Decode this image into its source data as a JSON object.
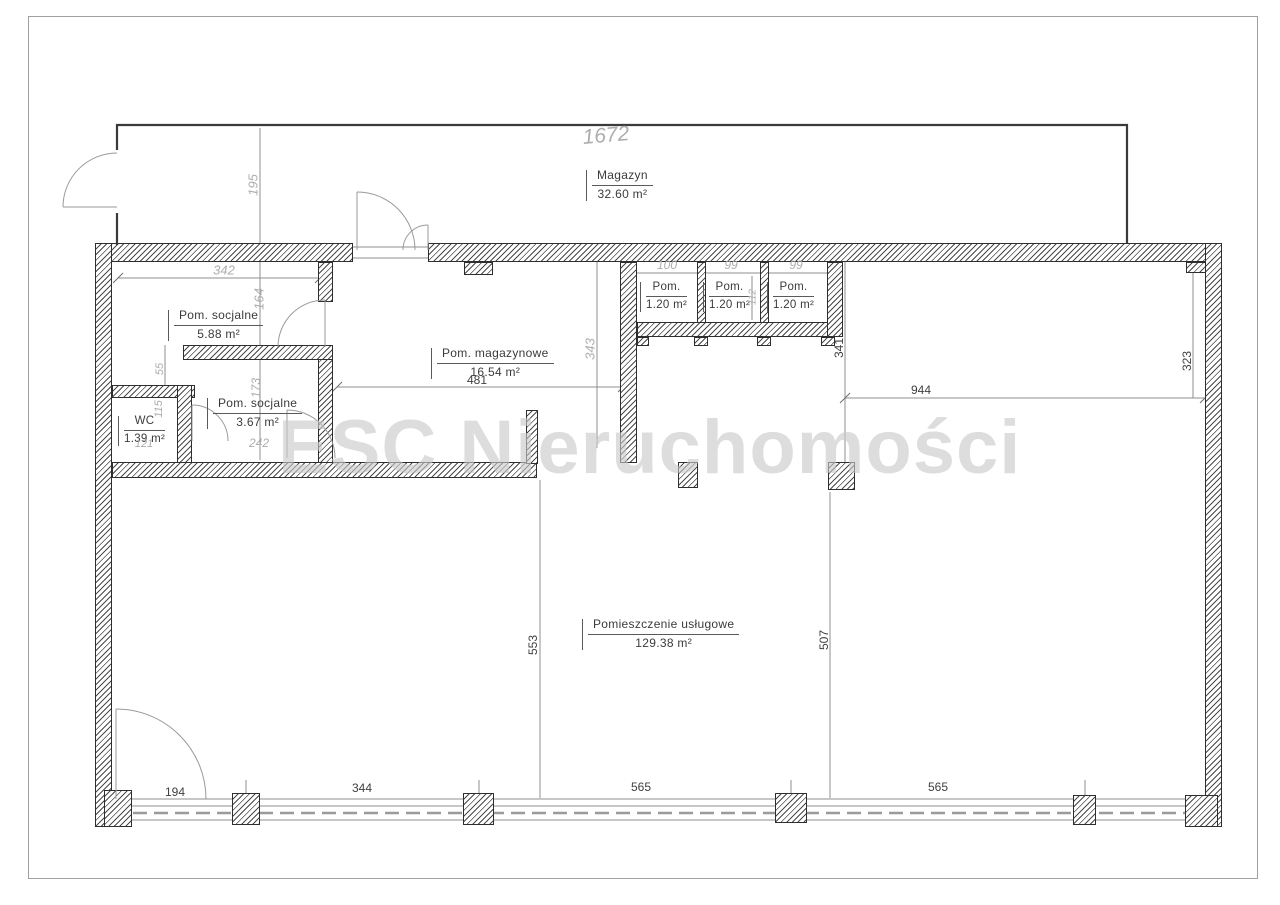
{
  "watermark": "ESC Nieruchomości",
  "rooms": {
    "magazyn": {
      "name": "Magazyn",
      "area": "32.60 m²"
    },
    "socjalne1": {
      "name": "Pom. socjalne",
      "area": "5.88 m²"
    },
    "wc": {
      "name": "WC",
      "area": "1.39 m²"
    },
    "socjalne2": {
      "name": "Pom. socjalne",
      "area": "3.67 m²"
    },
    "magazynowe": {
      "name": "Pom. magazynowe",
      "area": "16.54 m²"
    },
    "pom1": {
      "name": "Pom.",
      "area": "1.20 m²"
    },
    "pom2": {
      "name": "Pom.",
      "area": "1.20 m²"
    },
    "pom3": {
      "name": "Pom.",
      "area": "1.20 m²"
    },
    "uslugowe": {
      "name": "Pomieszczenie usługowe",
      "area": "129.38 m²"
    }
  },
  "dims": {
    "d1672": "1672",
    "d195": "195",
    "d342": "342",
    "d164": "164",
    "d55": "55",
    "d173": "173",
    "d115": "115",
    "d121": "121",
    "d242": "242",
    "d343": "343",
    "d100": "100",
    "d99a": "99",
    "d99b": "99",
    "d112": "112",
    "d481": "481",
    "d944": "944",
    "d341": "341",
    "d323": "323",
    "d553": "553",
    "d507": "507",
    "d194": "194",
    "d344": "344",
    "d565a": "565",
    "d565b": "565"
  },
  "colors": {
    "wall_line": "#2e2e2e",
    "dim_text": "#3f3f3f",
    "handwritten": "#aeacac",
    "watermark": "#c9c9c9"
  }
}
